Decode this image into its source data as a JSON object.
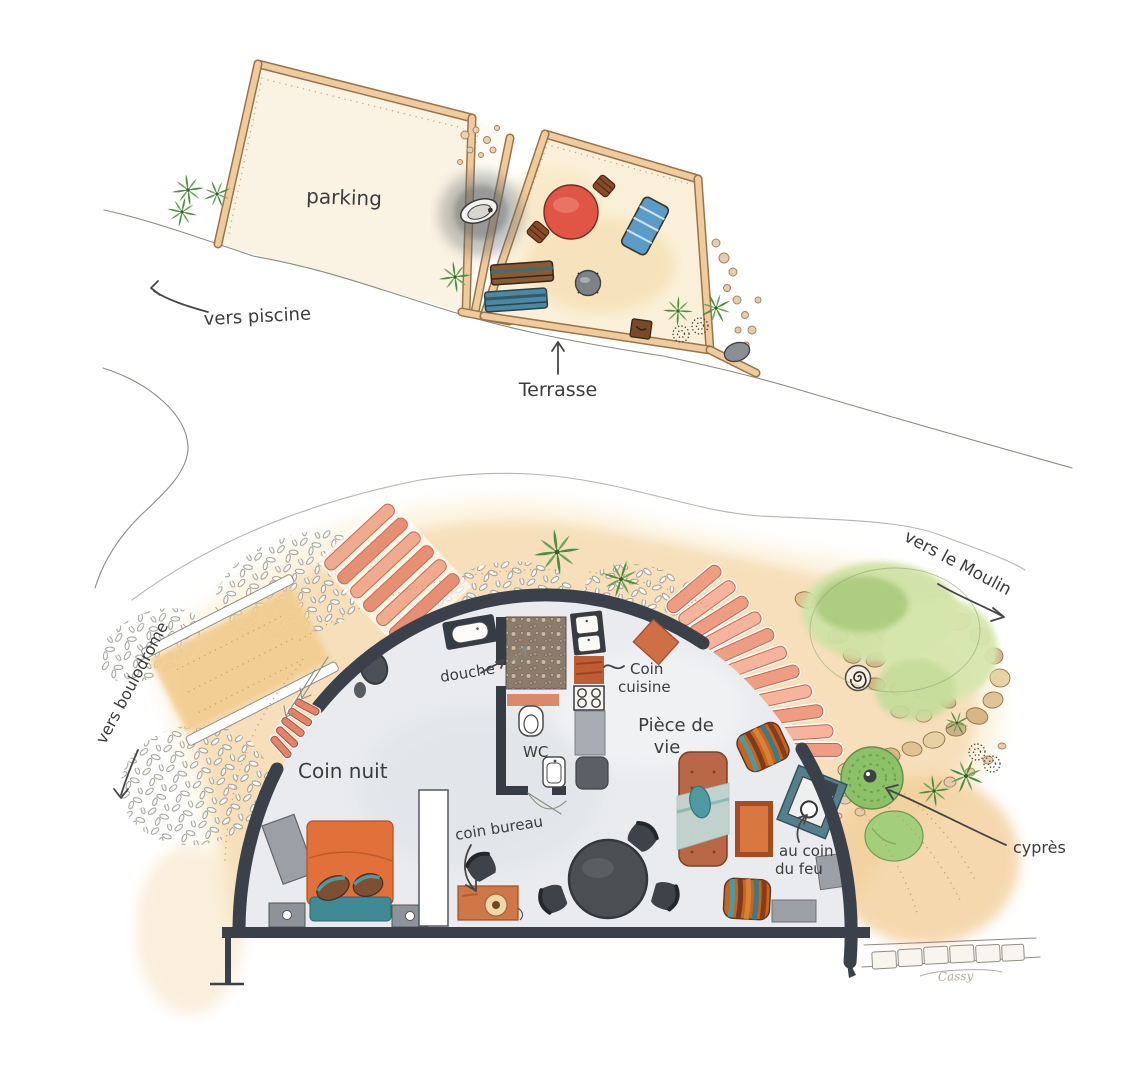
{
  "plan": {
    "upper_site_plan": {
      "parking_label": "parking",
      "terrasse_label": "Terrasse",
      "direction_piscine": "vers piscine"
    },
    "dome_floor_plan": {
      "room_coin_nuit": "Coin nuit",
      "room_douche": "douche",
      "room_wc": "WC",
      "room_coin_cuisine_line1": "Coin",
      "room_coin_cuisine_line2": "cuisine",
      "room_piece_de_vie_line1": "Pièce de",
      "room_piece_de_vie_line2": "vie",
      "zone_coin_bureau": "coin bureau",
      "zone_au_coin_du_feu_line1": "au coin",
      "zone_au_coin_du_feu_line2": "du feu"
    },
    "garden": {
      "direction_moulin": "vers le Moulin",
      "direction_boulodrome": "vers boulodrome",
      "tree_cypres": "cyprès"
    },
    "signature": "Cassy"
  },
  "palette": {
    "wall_dark": "#3a414a",
    "terracotta": "#cf6f45",
    "salmon_step": "#ef9f85",
    "teal": "#4f99a0",
    "sand": "#f5d9ae",
    "green_canopy": "#cfe2a6",
    "green_tree": "#8cc169",
    "red_table": "#e05545",
    "orange_bed": "#e2703a",
    "floor_gray": "#e9ebee"
  }
}
